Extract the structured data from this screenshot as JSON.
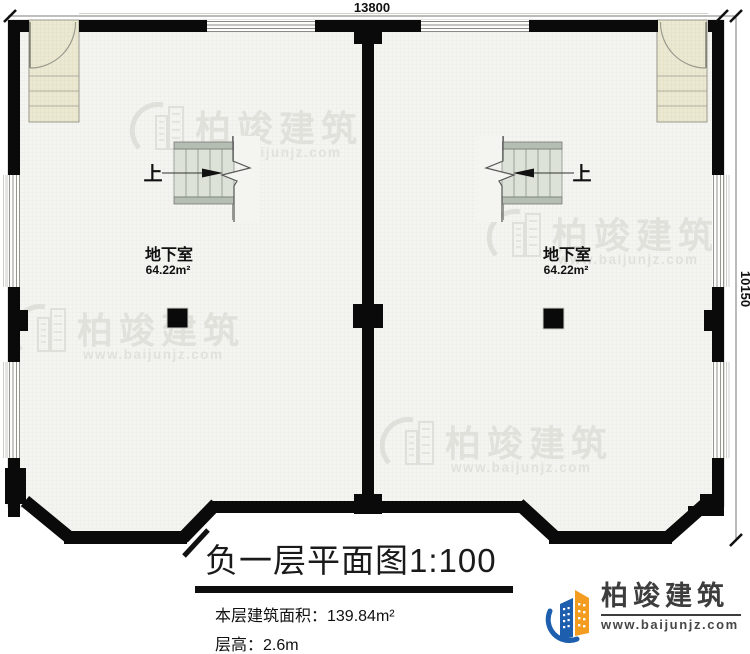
{
  "dimensions": {
    "top": "13800",
    "right": "10150"
  },
  "rooms": {
    "left": {
      "name": "地下室",
      "area": "64.22m²",
      "stair": "上"
    },
    "right": {
      "name": "地下室",
      "area": "64.22m²",
      "stair": "上"
    }
  },
  "titleblock": {
    "title": "负一层平面图1:100",
    "floor_area": "本层建筑面积：139.84m²",
    "floor_height": "层高：2.6m"
  },
  "watermark": {
    "brand": "柏竣建筑",
    "url": "www.baijunjz.com"
  },
  "logo": {
    "brand": "柏竣建筑",
    "url": "www.baijunjz.com"
  },
  "colors": {
    "wall": "#0a0a0a",
    "floor": "#f4f4f1",
    "floor_grid": "#e6e6e1",
    "porch": "#ece9d3",
    "porch_grid": "#dcd8bd",
    "stair_body": "#dce2d7",
    "stair_cap": "#b5beb2",
    "watermark": "#e1e1dc",
    "logo_blue": "#1d5fae",
    "logo_orange": "#f49c1f",
    "text": "#111111"
  }
}
